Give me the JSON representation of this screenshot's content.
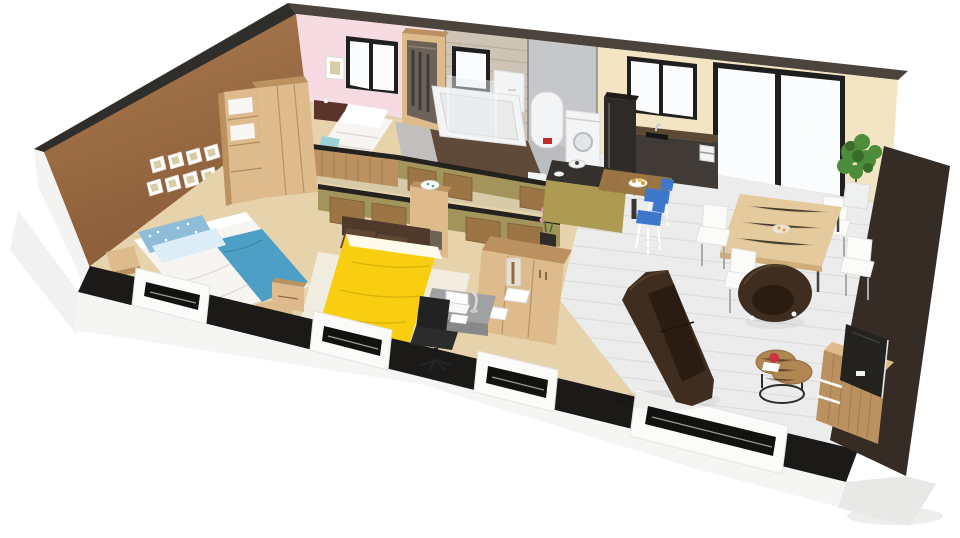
{
  "scene": {
    "title": "Isometric 3D cutaway floor plan render of a single-storey house",
    "type": "3d-floor-plan-render"
  },
  "rooms": [
    {
      "name": "bedroom-1",
      "furniture": [
        "double-bed-white-blue",
        "single-bed",
        "wardrobe-divider",
        "open-wardrobe",
        "picture-frames-wall",
        "wood-stools"
      ]
    },
    {
      "name": "bathroom",
      "furniture": [
        "bathtub",
        "glass-screen",
        "wall-cabinet",
        "stone-accent-wall"
      ]
    },
    {
      "name": "utility-room",
      "furniture": [
        "water-heater",
        "washing-machine",
        "toilet"
      ]
    },
    {
      "name": "kitchen",
      "furniture": [
        "refrigerator",
        "counter-with-sink",
        "coffee-machine",
        "island",
        "bar-table",
        "bar-stools",
        "fruit-bowl"
      ]
    },
    {
      "name": "dining-area",
      "furniture": [
        "dining-table",
        "white-chairs",
        "potted-plant"
      ]
    },
    {
      "name": "bedroom-2",
      "furniture": [
        "double-bed-yellow",
        "headboard",
        "nightstand",
        "shelf-cabinet",
        "desk",
        "office-chair",
        "laptop"
      ]
    },
    {
      "name": "living-room",
      "furniture": [
        "sofa",
        "armchair",
        "round-coffee-table",
        "tv-stand",
        "tv",
        "sideboard",
        "orchid",
        "lamp"
      ]
    }
  ],
  "colors": {
    "background": "#ffffff",
    "cutTopBack": "#4a443c",
    "cutTopLeft": "#302e2b",
    "cutTopFront": "#1b1a18",
    "cutTopRight": "#342c25",
    "cutTopPartition": "#23221f",
    "wallBrown": "#ab7b50",
    "wallBrownDark": "#8a5c38",
    "wallPink": "#f6dbe2",
    "wallStone": "#cec4b6",
    "stoneLine": "#b2a594",
    "wallGray": "#c6c7cb",
    "wallCream": "#f3e5c3",
    "wallOuterWhite": "#f3f3f2",
    "foundationFace": "#f5f5f4",
    "foundationShade": "#e3e3e1",
    "recessDark": "#121210",
    "recessLine": "#9a9a98",
    "groundShadow": "#e8e8e7",
    "windowFrame": "#1f1f1f",
    "windowPane": "#fafcfd",
    "glassTint": "#e9eff2",
    "partitionOlive": "#a2945a",
    "woodLight": "#ddbb8c",
    "woodMid": "#bb9160",
    "woodDark": "#8f6a3f",
    "woodSlat": "#9c7545",
    "counterDark": "#403b36",
    "counterTop": "#5c4833",
    "fridgeDark": "#2e2a27",
    "applianceWhite": "#f3f4f5",
    "heaterRed": "#c32b2b",
    "floorTan": "#e7d3ab",
    "floorHall": "#c9c2a8",
    "floorBath": "#5f4a39",
    "floorUtility": "#bbbcc0",
    "floorLiving": "#ebeceb",
    "plankLine": "#dadbd9",
    "rugWhite": "#f2f0e9",
    "bedWhite": "#f6f5f1",
    "bedShade": "#dcd8cf",
    "pillowBlue": "#8fbcd9",
    "pillowPale": "#dcedf8",
    "pillowTeal": "#9fd2d4",
    "throwBlue": "#4d9fc6",
    "bedYellow": "#f9ce10",
    "bedYellowDark": "#dbb108",
    "pillowBrown": "#5f4733",
    "headboardBrown": "#4e392a",
    "sofaBrown": "#3f2d1f",
    "sofaDark": "#2a1c11",
    "chairWhite": "#fbfbfa",
    "chairLeg": "#a8abae",
    "stoolBlue": "#3e78cc",
    "deskGray": "#a0a1a3",
    "deskGrayDark": "#87888a",
    "chairBlack": "#222222",
    "tableWood": "#e4ca9c",
    "tableWoodEdge": "#cfae7c",
    "tvBlack": "#23221f",
    "orchidPink": "#e492b5",
    "plantGreen": "#4d8c3a",
    "plantGreenDark": "#3a6d2c",
    "potWhite": "#eff1f0",
    "redAccent": "#cc3340",
    "fruitOrange": "#e8923e",
    "lampShade": "#e9e3d7",
    "islandTop": "#35312d",
    "islandGold": "#ac9b50",
    "coffeeWood": "#b08753",
    "wardrobeInterior": "#6e6158",
    "nightstandRed": "#5a342a",
    "frameWhite": "#ffffff",
    "artTone": "#d9cba4",
    "linenWhite": "#f7f7f4"
  }
}
